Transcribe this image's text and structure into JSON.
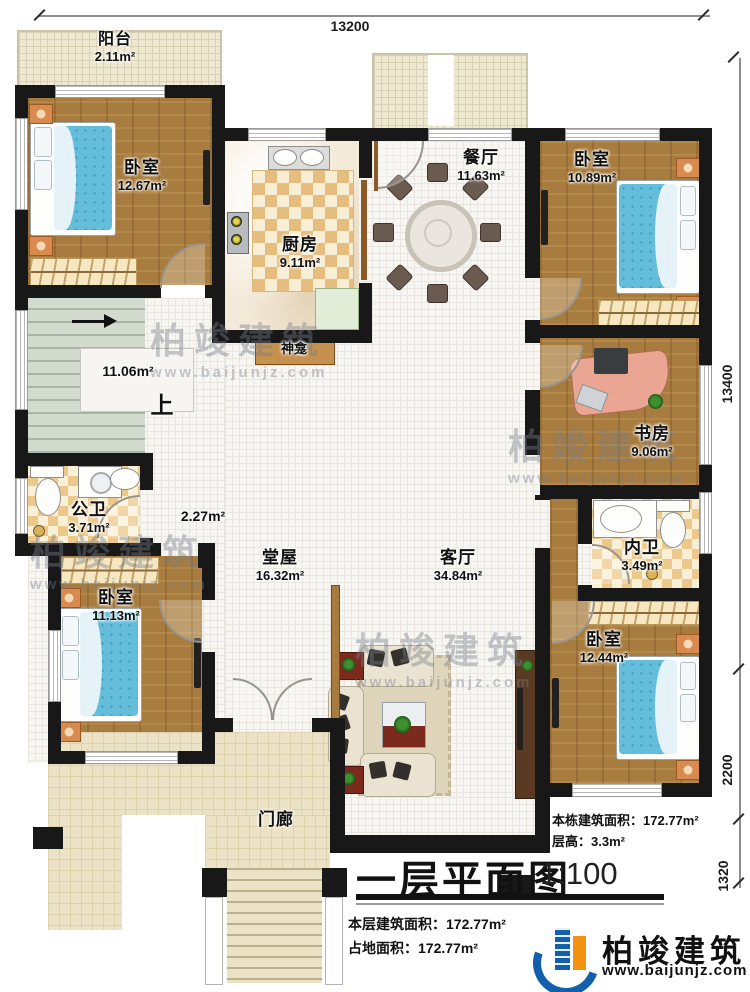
{
  "dimensions": {
    "top": "13200",
    "right_upper": "13400",
    "right_lower": "2200",
    "right_bottom": "1320"
  },
  "rooms": {
    "balcony": {
      "name": "阳台",
      "area": "2.11m²"
    },
    "bedroom_tl": {
      "name": "卧室",
      "area": "12.67m²"
    },
    "kitchen": {
      "name": "厨房",
      "area": "9.11m²"
    },
    "dining": {
      "name": "餐厅",
      "area": "11.63m²"
    },
    "bedroom_tr": {
      "name": "卧室",
      "area": "10.89m²"
    },
    "stairs": {
      "area": "11.06m²",
      "up_label": "上"
    },
    "shrine": {
      "name": "神龛"
    },
    "study": {
      "name": "书房",
      "area": "9.06m²"
    },
    "public_bath": {
      "name": "公卫",
      "area": "3.71m²"
    },
    "corridor": {
      "area": "2.27m²"
    },
    "main_hall": {
      "name": "堂屋",
      "area": "16.32m²"
    },
    "living": {
      "name": "客厅",
      "area": "34.84m²"
    },
    "inner_bath": {
      "name": "内卫",
      "area": "3.49m²"
    },
    "bedroom_bl": {
      "name": "卧室",
      "area": "11.13m²"
    },
    "bedroom_br": {
      "name": "卧室",
      "area": "12.44m²"
    },
    "porch": {
      "name": "门廊"
    }
  },
  "title_block": {
    "title": "一层平面图",
    "scale": "1:100",
    "building_area_label": "本栋建筑面积：",
    "building_area_value": "172.77m²",
    "floor_height_label": "层高：",
    "floor_height_value": "3.3m²",
    "floor_area_label": "本层建筑面积：",
    "floor_area_value": "172.77m²",
    "footprint_label": "占地面积：",
    "footprint_value": "172.77m²"
  },
  "brand": {
    "name": "柏竣建筑",
    "url": "www.baijunjz.com"
  },
  "watermark": {
    "name": "柏竣建筑",
    "url": "www.baijunjz.com"
  },
  "colors": {
    "wall": "#181818",
    "wood_floor": "#a87c3e",
    "bed_blue": "#64bedb",
    "checker_tile": "#e5bd7e",
    "brand_blue": "#1260ab",
    "brand_orange": "#f29210"
  }
}
